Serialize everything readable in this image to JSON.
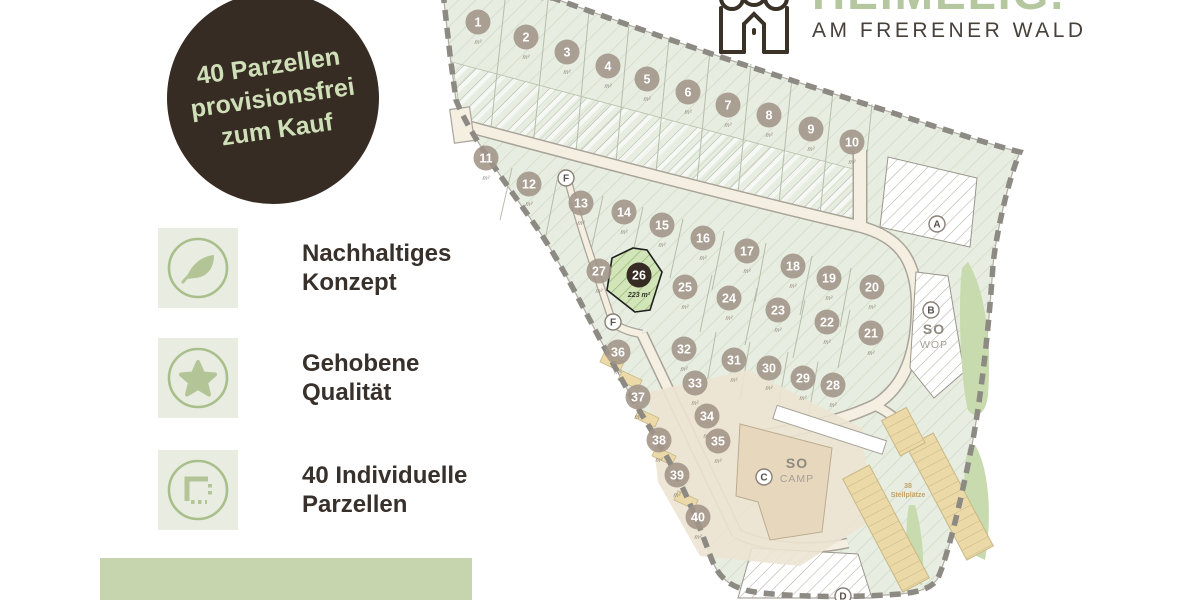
{
  "badge": {
    "line1": "40 Parzellen",
    "line2": "provisionsfrei",
    "line3": "zum Kauf"
  },
  "features": [
    {
      "icon": "leaf-icon",
      "line1": "Nachhaltiges",
      "line2": "Konzept"
    },
    {
      "icon": "star-icon",
      "line1": "Gehobene",
      "line2": "Qualität"
    },
    {
      "icon": "parcel-icon",
      "line1": "40 Individuelle",
      "line2": "Parzellen"
    }
  ],
  "logo": {
    "name": "HEIMELIG.",
    "tagline": "AM FRERENER WALD"
  },
  "map": {
    "area_unit": "m²",
    "highlight_plot": {
      "number": "26",
      "area": "223 m²"
    },
    "plots": [
      {
        "n": "1",
        "x": 478,
        "y": 22
      },
      {
        "n": "2",
        "x": 526,
        "y": 37
      },
      {
        "n": "3",
        "x": 567,
        "y": 52
      },
      {
        "n": "4",
        "x": 608,
        "y": 66
      },
      {
        "n": "5",
        "x": 647,
        "y": 79
      },
      {
        "n": "6",
        "x": 688,
        "y": 92
      },
      {
        "n": "7",
        "x": 728,
        "y": 105
      },
      {
        "n": "8",
        "x": 769,
        "y": 115
      },
      {
        "n": "9",
        "x": 811,
        "y": 129
      },
      {
        "n": "10",
        "x": 852,
        "y": 142
      },
      {
        "n": "11",
        "x": 486,
        "y": 158
      },
      {
        "n": "12",
        "x": 529,
        "y": 184
      },
      {
        "n": "13",
        "x": 581,
        "y": 203
      },
      {
        "n": "14",
        "x": 624,
        "y": 212
      },
      {
        "n": "15",
        "x": 662,
        "y": 225
      },
      {
        "n": "16",
        "x": 703,
        "y": 238
      },
      {
        "n": "17",
        "x": 747,
        "y": 251
      },
      {
        "n": "18",
        "x": 793,
        "y": 266
      },
      {
        "n": "19",
        "x": 829,
        "y": 278
      },
      {
        "n": "20",
        "x": 872,
        "y": 287
      },
      {
        "n": "21",
        "x": 871,
        "y": 333
      },
      {
        "n": "22",
        "x": 827,
        "y": 322
      },
      {
        "n": "23",
        "x": 778,
        "y": 310
      },
      {
        "n": "24",
        "x": 729,
        "y": 298
      },
      {
        "n": "25",
        "x": 685,
        "y": 287
      },
      {
        "n": "26",
        "x": 639,
        "y": 275,
        "highlight": true
      },
      {
        "n": "27",
        "x": 599,
        "y": 271
      },
      {
        "n": "28",
        "x": 833,
        "y": 385
      },
      {
        "n": "29",
        "x": 803,
        "y": 378
      },
      {
        "n": "30",
        "x": 769,
        "y": 368
      },
      {
        "n": "31",
        "x": 734,
        "y": 360
      },
      {
        "n": "32",
        "x": 684,
        "y": 349
      },
      {
        "n": "33",
        "x": 695,
        "y": 383
      },
      {
        "n": "34",
        "x": 707,
        "y": 416
      },
      {
        "n": "35",
        "x": 718,
        "y": 441
      },
      {
        "n": "36",
        "x": 618,
        "y": 352
      },
      {
        "n": "37",
        "x": 638,
        "y": 397
      },
      {
        "n": "38",
        "x": 659,
        "y": 440
      },
      {
        "n": "39",
        "x": 677,
        "y": 475
      },
      {
        "n": "40",
        "x": 698,
        "y": 517
      }
    ],
    "letters": [
      {
        "label": "F",
        "x": 566,
        "y": 178
      },
      {
        "label": "F",
        "x": 613,
        "y": 322
      },
      {
        "label": "A",
        "x": 937,
        "y": 224
      },
      {
        "label": "B",
        "x": 931,
        "y": 310
      },
      {
        "label": "C",
        "x": 764,
        "y": 477
      },
      {
        "label": "D",
        "x": 843,
        "y": 596
      }
    ],
    "zones": [
      {
        "title": "SO",
        "subtitle": "WOP",
        "x": 934,
        "y": 334
      },
      {
        "title": "SO",
        "subtitle": "CAMP",
        "x": 797,
        "y": 468
      }
    ],
    "parking_label_line1": "38",
    "parking_label_line2": "Stellplätze"
  },
  "colors": {
    "badge_bg": "#372c23",
    "badge_text": "#cfe0b8",
    "tile_bg": "#e9ece1",
    "icon_green": "#b3c596",
    "heading": "#38302a",
    "strip": "#c6d5ad",
    "logo_green": "#b4c79e",
    "logo_dark": "#47413a",
    "map_green": "#e7ede1",
    "road": "#f5efe2",
    "boundary": "#8d8983",
    "marker": "#a29488",
    "marker_highlight": "#372c23",
    "veg": "#c7dbae",
    "stall": "#ebdaa8"
  }
}
